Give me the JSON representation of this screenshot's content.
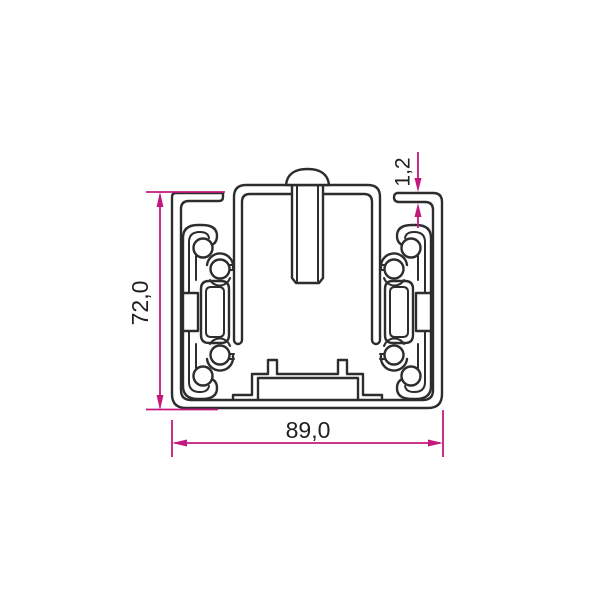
{
  "drawing": {
    "type": "technical-cross-section",
    "subject": "drawer-slide profile cross-section",
    "colors": {
      "line": "#2d2d2d",
      "dimension": "#c4187c",
      "background": "#ffffff",
      "text": "#1f1f1f"
    },
    "dimensions": {
      "height": {
        "label": "72,0",
        "orientation": "vertical"
      },
      "width": {
        "label": "89,0",
        "orientation": "horizontal"
      },
      "wall_thickness": {
        "label": "1,2",
        "orientation": "vertical"
      }
    }
  }
}
